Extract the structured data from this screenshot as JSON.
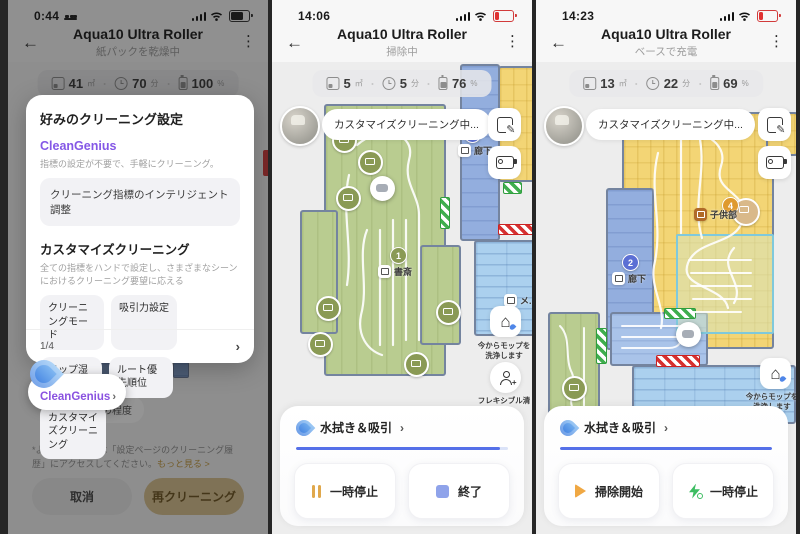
{
  "icons": {
    "back": "←",
    "kebab": "⋮",
    "chevron": "›",
    "home": "⌂",
    "person_plus": "+"
  },
  "colors": {
    "accent_blue": "#5570e8",
    "cleangenius_purple": "#8457e6",
    "link_gold": "#c49a3f",
    "confirm_gold": "#d9c28f",
    "battery_low_red": "#e03131",
    "room_green": "#b9cc90",
    "room_blue": "#93aede",
    "room_yellow": "#f3d575",
    "room_lightblue": "#abd0ee",
    "no_go_red": "#d63030",
    "virtual_wall_green": "#3fae4e",
    "badge_olive": "#8a9a55",
    "badge_blue": "#5b6fd4",
    "badge_orange": "#df9a2e",
    "play_orange": "#f0a843",
    "bolt_green": "#3dbd62",
    "pause_gold": "#e0a84c",
    "stop_blue": "#8fa3ea"
  },
  "screens": [
    {
      "status": {
        "time": "0:44"
      },
      "header": {
        "title": "Aqua10 Ultra Roller",
        "subtitle": "紙パックを乾燥中"
      },
      "stats": {
        "area_value": "41",
        "area_unit": "㎡",
        "time_value": "70",
        "time_unit": "分",
        "battery_value": "100",
        "battery_unit": "%"
      },
      "dialog": {
        "title": "好みのクリーニング設定",
        "cleangenius": {
          "name": "CleanGenius",
          "desc": "指標の設定が不要で、手軽にクリーニング。",
          "action": "クリーニング指標のインテリジェント調整"
        },
        "custom": {
          "title": "カスタマイズクリーニング",
          "desc": "全ての指標をハンドで設定し、さまざまなシーンにおけるクリーニング要望に応える",
          "chips": [
            "クリーニングモード",
            "吸引力設定",
            "モップ湿度",
            "ルート優先順位",
            "カスタマイズクリーニング"
          ]
        },
        "pagination": "1/4"
      },
      "background": {
        "chip_label": "汚れの程度"
      },
      "spotlight": {
        "label": "CleanGenius"
      },
      "footnote": {
        "text": "*より詳しい情報は「設定ページのクリーニング履歴」にアクセスしてください。",
        "link": "もっと見る >"
      },
      "actions": {
        "cancel": "取消",
        "confirm": "再クリーニング"
      }
    },
    {
      "status": {
        "time": "14:06"
      },
      "header": {
        "title": "Aqua10 Ultra Roller",
        "subtitle": "掃除中"
      },
      "stats": {
        "area_value": "5",
        "area_unit": "㎡",
        "time_value": "5",
        "time_unit": "分",
        "battery_value": "76",
        "battery_unit": "%"
      },
      "banner": {
        "label": "カスタマイズクリーニング中..."
      },
      "map": {
        "rooms": {
          "study": {
            "label": "書斎",
            "badge": "1"
          },
          "hallway": {
            "label": "廊下",
            "badge": "2"
          },
          "tiled": {
            "label": "メ..."
          }
        }
      },
      "floating": {
        "mop_line1": "今からモップを",
        "mop_line2": "洗浄します",
        "flex_line1": "フレキシブル清",
        "flex_line2": "掃"
      },
      "sheet": {
        "mode": "水拭き＆吸引",
        "progress_pct": 96,
        "pause_label": "一時停止",
        "stop_label": "終了"
      }
    },
    {
      "status": {
        "time": "14:23"
      },
      "header": {
        "title": "Aqua10 Ultra Roller",
        "subtitle": "ベースで充電"
      },
      "stats": {
        "area_value": "13",
        "area_unit": "㎡",
        "time_value": "22",
        "time_unit": "分",
        "battery_value": "69",
        "battery_unit": "%"
      },
      "banner": {
        "label": "カスタマイズクリーニング中..."
      },
      "map": {
        "rooms": {
          "kids_room": {
            "label": "子供部",
            "badge": "4"
          },
          "hallway": {
            "label": "廊下",
            "badge": "2"
          }
        }
      },
      "floating": {
        "mop_line1": "今からモップを",
        "mop_line2": "洗浄します"
      },
      "sheet": {
        "mode": "水拭き＆吸引",
        "progress_pct": 100,
        "start_label": "掃除開始",
        "pause_label": "一時停止"
      }
    }
  ]
}
